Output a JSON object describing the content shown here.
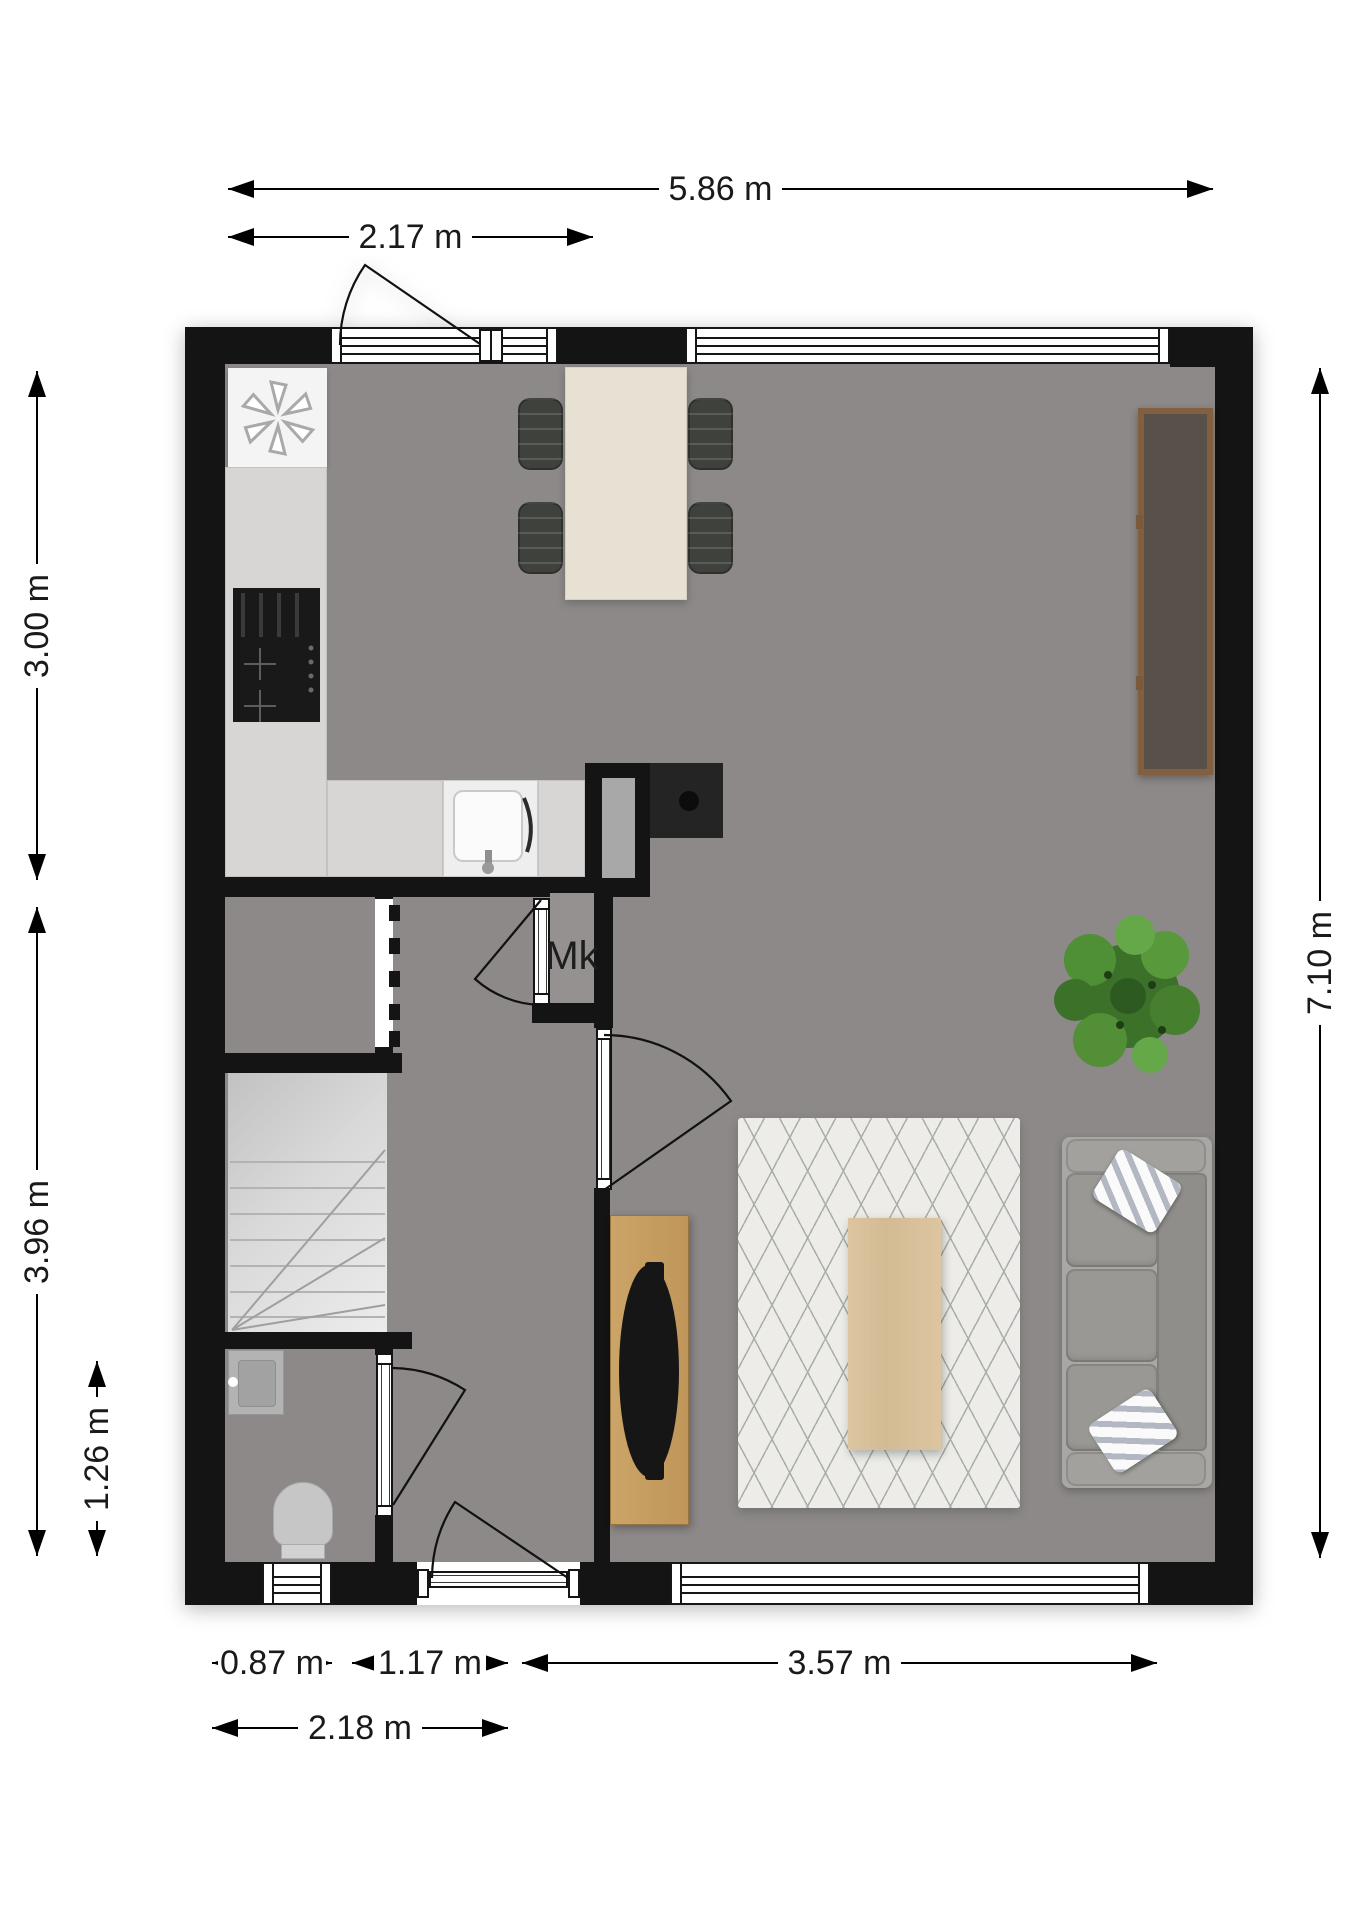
{
  "title": "Floor plan – ground floor",
  "units": "m",
  "labels": {
    "meter_cupboard": "Mk"
  },
  "dimensions": {
    "top": [
      {
        "label": "5.86 m",
        "value": 5.86
      },
      {
        "label": "2.17 m",
        "value": 2.17
      }
    ],
    "left": [
      {
        "label": "3.00 m",
        "value": 3.0
      },
      {
        "label": "3.96 m",
        "value": 3.96
      },
      {
        "label": "1.26 m",
        "value": 1.26
      }
    ],
    "right": [
      {
        "label": "7.10 m",
        "value": 7.1
      }
    ],
    "bottom": [
      {
        "label": "0.87 m",
        "value": 0.87
      },
      {
        "label": "1.17 m",
        "value": 1.17
      },
      {
        "label": "3.57 m",
        "value": 3.57
      },
      {
        "label": "2.18 m",
        "value": 2.18
      }
    ]
  },
  "colors": {
    "wall": "#141414",
    "floor": "#8c8988",
    "counter": "#d7d6d5",
    "stairs": "#d9d9d9",
    "dining_table": "#e7e1d3",
    "chair": "#3f413c",
    "rug": "#edece8",
    "coffee_table": "#d8c19c",
    "tv_stand": "#c79e62",
    "sideboard_frame": "#82603f",
    "sideboard_top": "#57514a",
    "sofa": "#9a9894",
    "plant": "#4c8a33",
    "dimension_text": "#1a1a1a"
  },
  "rooms": [
    "kitchen",
    "living-room",
    "dining-area",
    "hallway",
    "toilet",
    "stairs",
    "meter-cupboard"
  ],
  "furniture": [
    "dining-table",
    "dining-chairs",
    "sideboard",
    "plant",
    "rug",
    "coffee-table",
    "tv-stand",
    "tv",
    "sofa",
    "pillows",
    "stove",
    "sink",
    "fridge-vent",
    "toilet-bowl",
    "toilet-sink"
  ]
}
